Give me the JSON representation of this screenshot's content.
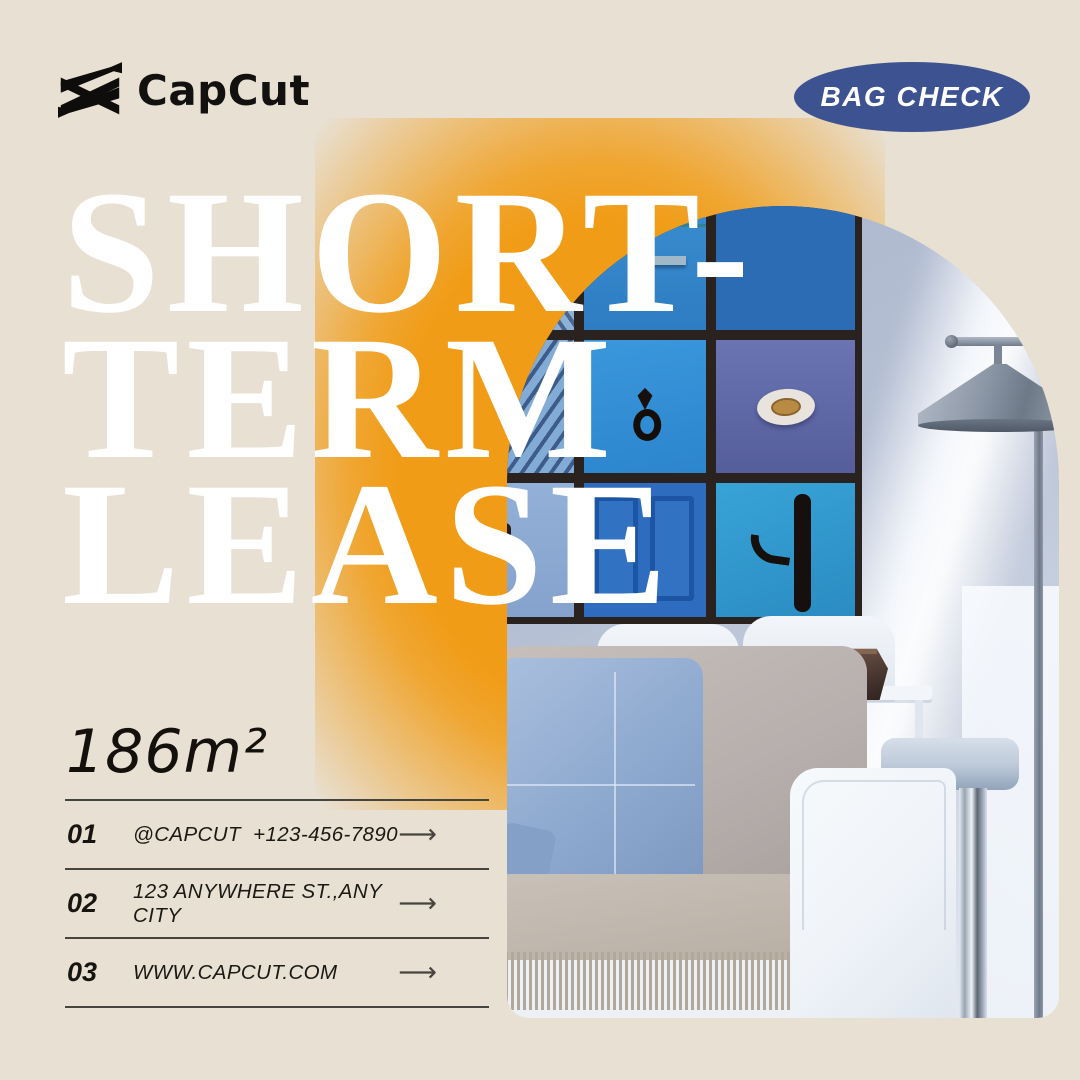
{
  "canvas": {
    "background": "#e8e0d2",
    "accent_glow": "#f19c16"
  },
  "header": {
    "brand": {
      "name": "CapCut",
      "logo_icon": "capcut-logo-icon",
      "color": "#121110"
    },
    "badge": {
      "label": "BAG CHECK",
      "bg": "#3d5291",
      "text_color": "#ffffff"
    }
  },
  "hero": {
    "title_lines": [
      "SHORT-",
      "TERM",
      "LEASE"
    ],
    "title_color": "#ffffff",
    "photo": {
      "subject": "living-room with blue door artwork grid, floor lamp and sofa",
      "wall_color": "#b6c0d4",
      "artwork_frame_color": "#2a221f",
      "artwork_cell_colors": [
        "#8cb2da",
        "#3c93d3",
        "#2b6cb4",
        "#82abd6",
        "#3b97dc",
        "#6b74b3",
        "#93b0d8",
        "#2d6cbe",
        "#38a3d6"
      ],
      "lamp_color": "#8c97a6",
      "pillow_color": "#90abd0",
      "blanket_color": "#b6ada3",
      "sofa_color": "#eff3f8",
      "vase_color": "#41302b"
    }
  },
  "details": {
    "area_label": "186m²",
    "arrow_glyph": "⟶",
    "rows": [
      {
        "index": "01",
        "text": "@CAPCUT  +123-456-7890"
      },
      {
        "index": "02",
        "text": "123 ANYWHERE ST.,ANY CITY"
      },
      {
        "index": "03",
        "text": "WWW.CAPCUT.COM"
      }
    ],
    "line_color": "#46443e"
  }
}
